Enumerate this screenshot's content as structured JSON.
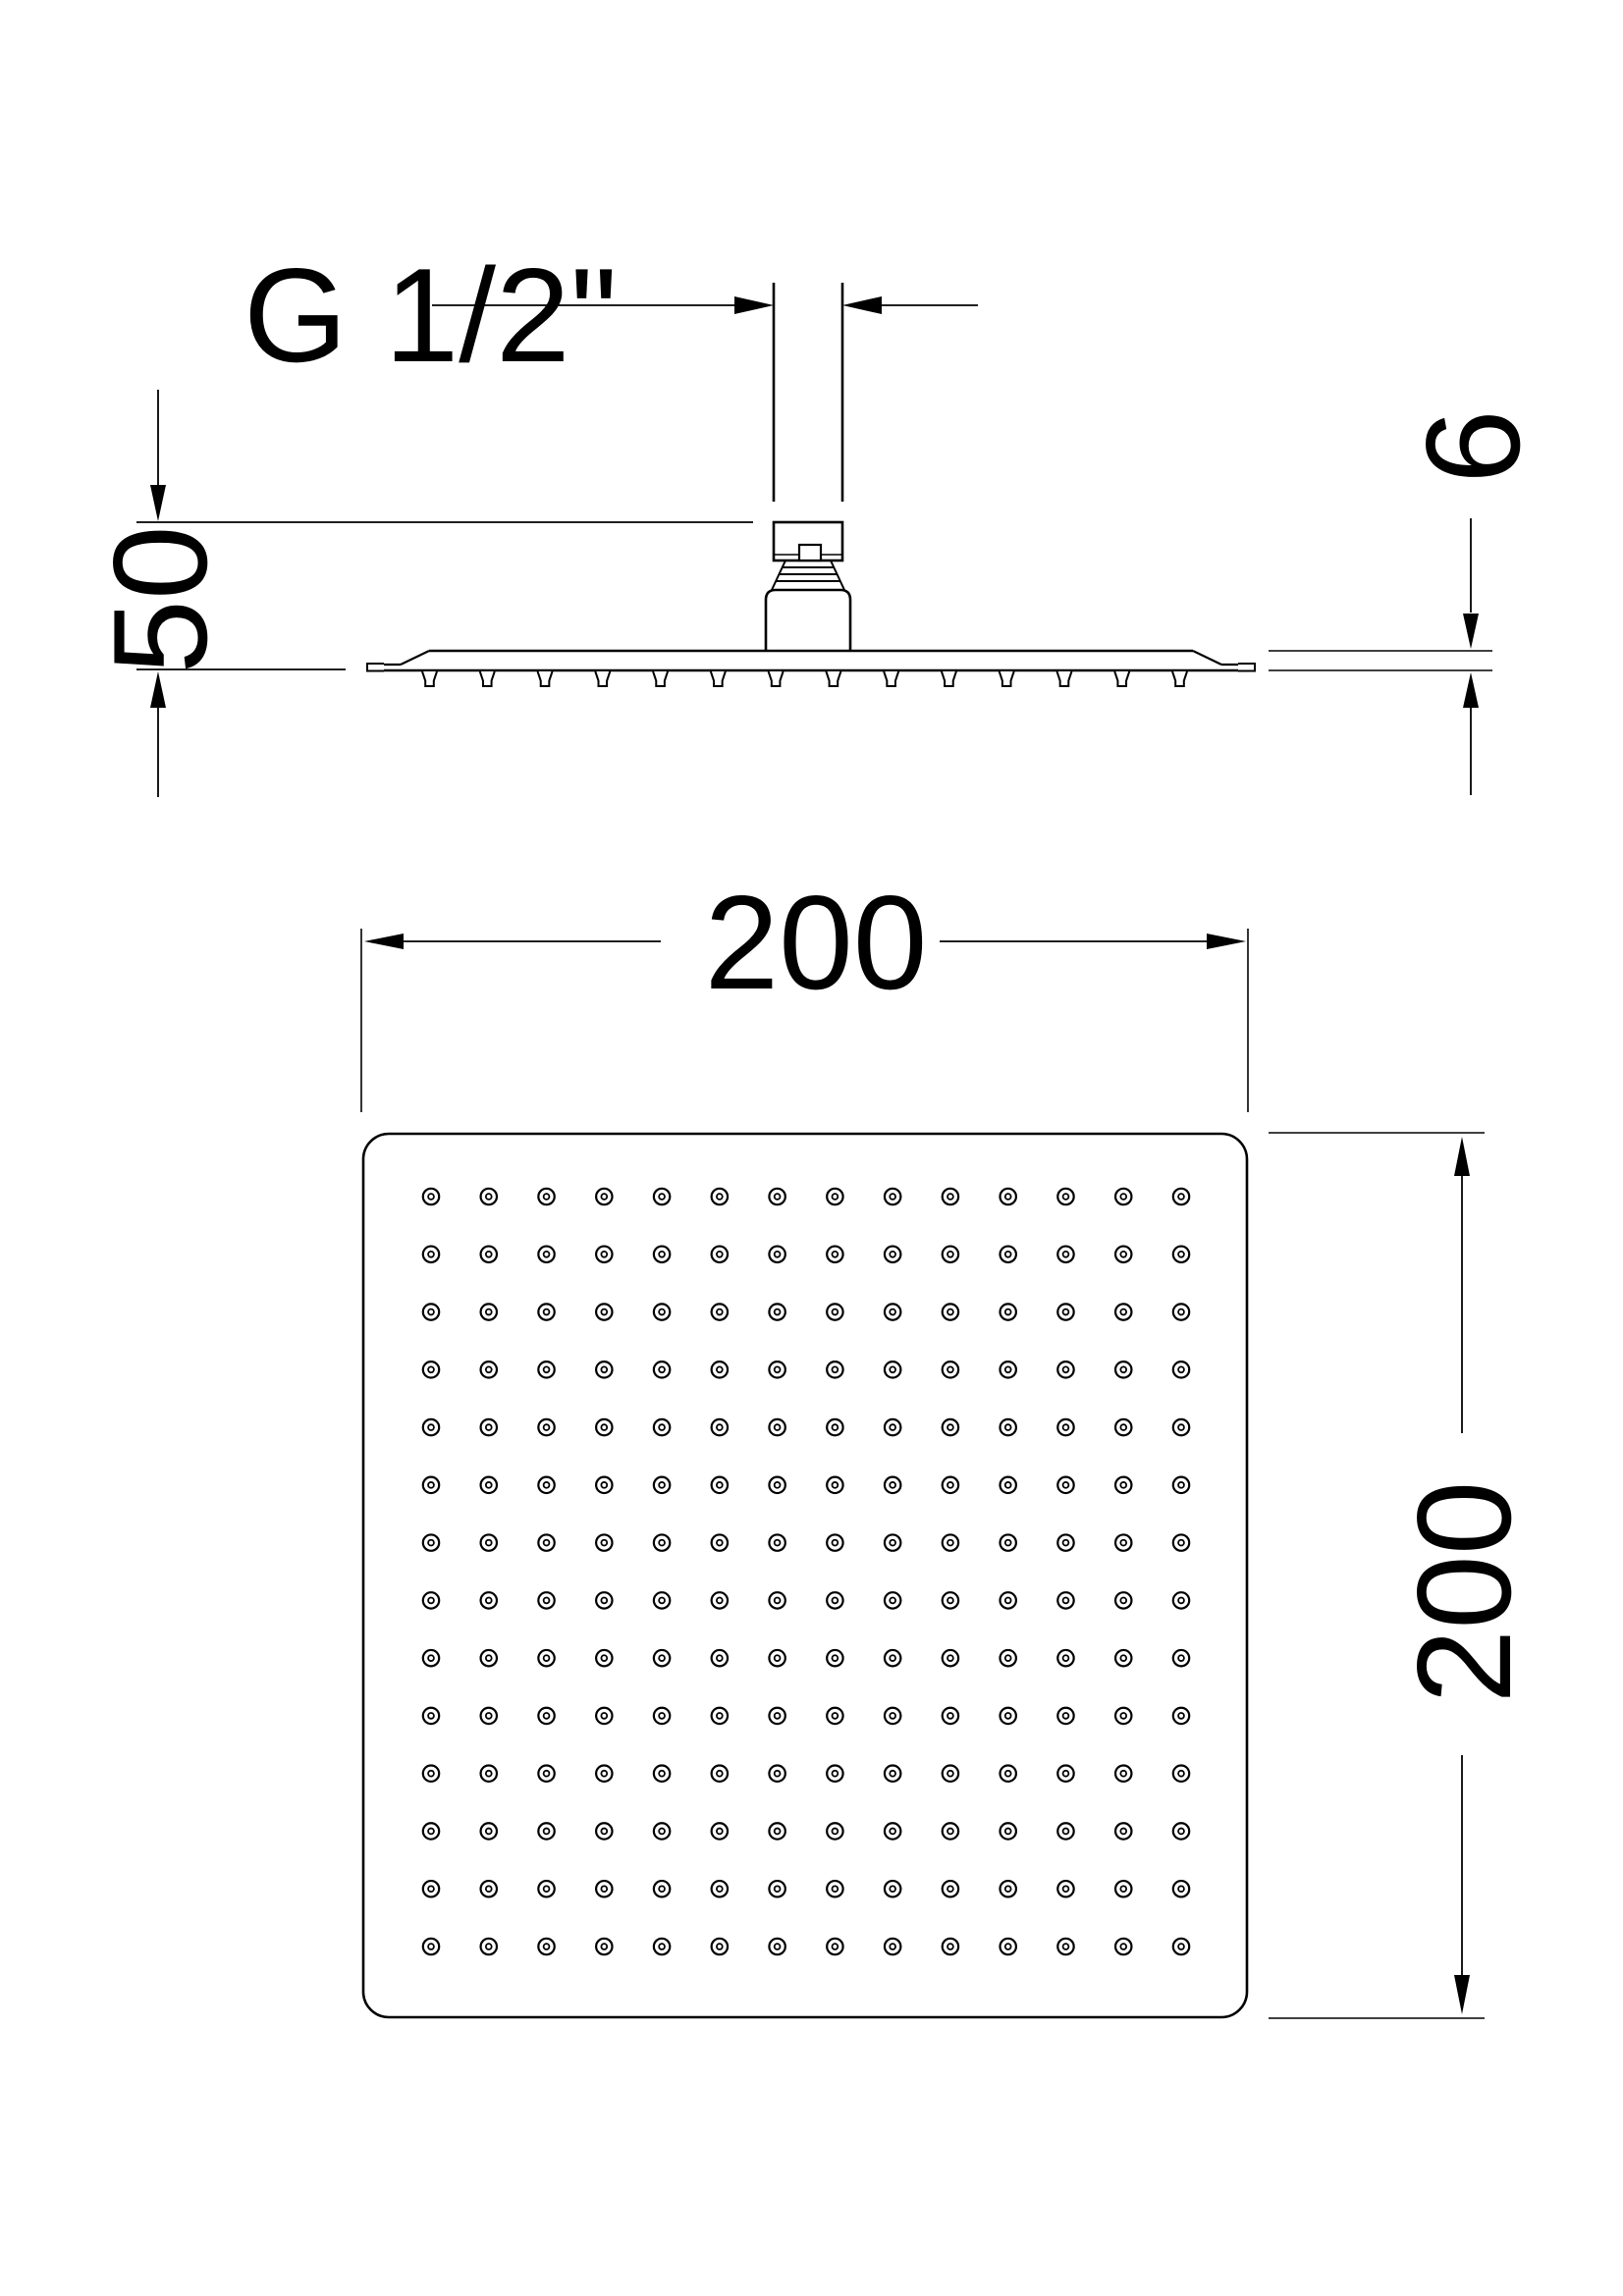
{
  "labels": {
    "thread_size": "G 1/2\"",
    "drop_height": "50",
    "plate_thickness": "6",
    "width": "200",
    "depth": "200"
  },
  "colors": {
    "line": "#000000",
    "background": "#ffffff"
  },
  "plan_grid": {
    "rows": 14,
    "cols": 14
  },
  "side_view": {
    "nozzle_count": 14
  }
}
